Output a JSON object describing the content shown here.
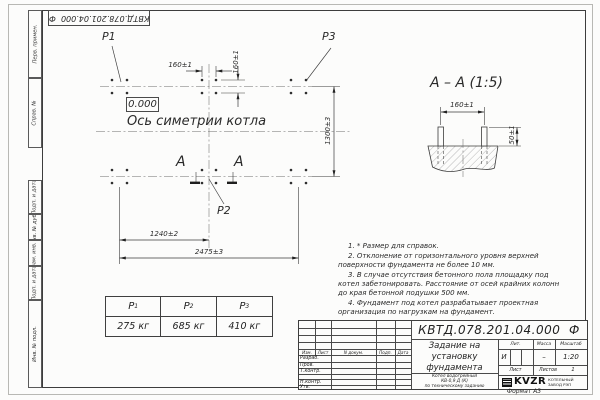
{
  "doc": {
    "number": "КВТД.078.201.04.000  Ф",
    "format_note": "Формат А3"
  },
  "margin_labels": [
    "Перв. примен.",
    "Справ. №",
    "Подп. и дата",
    "Инв. № дубл.",
    "Взам. инв. №",
    "Подп. и дата",
    "Инв. № подл."
  ],
  "plan": {
    "p1": "P1",
    "p2": "P2",
    "p3": "P3",
    "elevation": "0.000",
    "axis_label": "Ось симетрии котла",
    "section_letter_left": "А",
    "section_letter_right": "А",
    "dim_bolt_h": "160±1",
    "dim_bolt_v": "160±1",
    "dim_rows": "1300±3",
    "dim_left_mid": "1240±2",
    "dim_total": "2475±3"
  },
  "section_view": {
    "title": "А – А (1:5)",
    "dim_bolts": "160±1",
    "dim_protrusion": "50±1"
  },
  "load_table": {
    "headers": [
      {
        "letter": "P",
        "sub": "1"
      },
      {
        "letter": "P",
        "sub": "2"
      },
      {
        "letter": "P",
        "sub": "3"
      }
    ],
    "values": [
      "275 кг",
      "685 кг",
      "410 кг"
    ]
  },
  "notes": [
    "1.  * Размер для справок.",
    "2.  Отклонение от горизонтального уровня верхней поверхности фундамента не более 10 мм.",
    "3.  В случае отсутствия бетонного пола площадку под котел забетонировать. Расстояние от осей крайних колонн до края бетонной подушки 500 мм.",
    "4.  Фундамент под котел разрабатывает проектная организация по нагрузкам на фундамент."
  ],
  "title_block": {
    "doc_number": "КВТД.078.201.04.000  Ф",
    "title_lines": [
      "Задание на",
      "установку",
      "фундамента"
    ],
    "object_lines": [
      "Котел водогрейный",
      "КВ-0,9 Д (К)",
      "по техническому заданию"
    ],
    "header_cols": {
      "izm": "Изм.",
      "list": "Лист",
      "ndoc": "N докум.",
      "podp": "Подп.",
      "data": "Дата"
    },
    "rows": [
      "Разраб.",
      "Пров.",
      "Т.контр.",
      "Н.контр.",
      "Утв."
    ],
    "lit_label": "Лит.",
    "mass_label": "Масса",
    "scale_label": "Масштаб",
    "lit_value": "И",
    "mass_value": "–",
    "scale_value": "1:20",
    "sheet_label": "Лист",
    "sheets_label": "Листов",
    "sheets_value": "1",
    "company": "KVZR",
    "company_sub1": "КОТЕЛЬНЫЙ",
    "company_sub2": "ЗАВОД РЭП"
  }
}
